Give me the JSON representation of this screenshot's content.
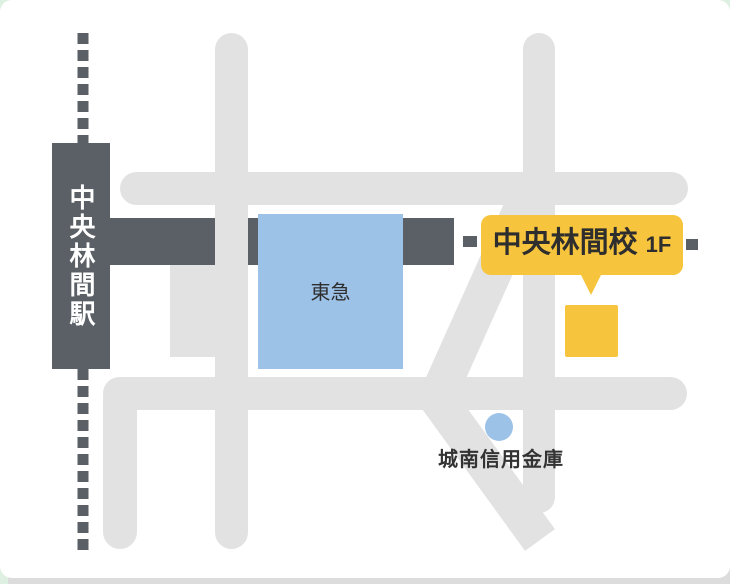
{
  "page": {
    "background_color": "#ddf0e1",
    "card_background": "#ffffff",
    "bottom_strip_color": "#dcdcdc"
  },
  "colors": {
    "dark_gray": "#5a6066",
    "road_gray": "#e2e2e2",
    "building_blue": "#9dc2e7",
    "highlight_yellow": "#f7c53d",
    "label_dark": "#2e2e2e",
    "station_text": "#ffffff"
  },
  "map": {
    "station": {
      "label": "中央林間駅"
    },
    "tokyu_building": {
      "label": "東急"
    },
    "school_callout": {
      "name": "中央林間校",
      "floor": "1F"
    },
    "bank": {
      "label": "城南信用金庫"
    }
  }
}
